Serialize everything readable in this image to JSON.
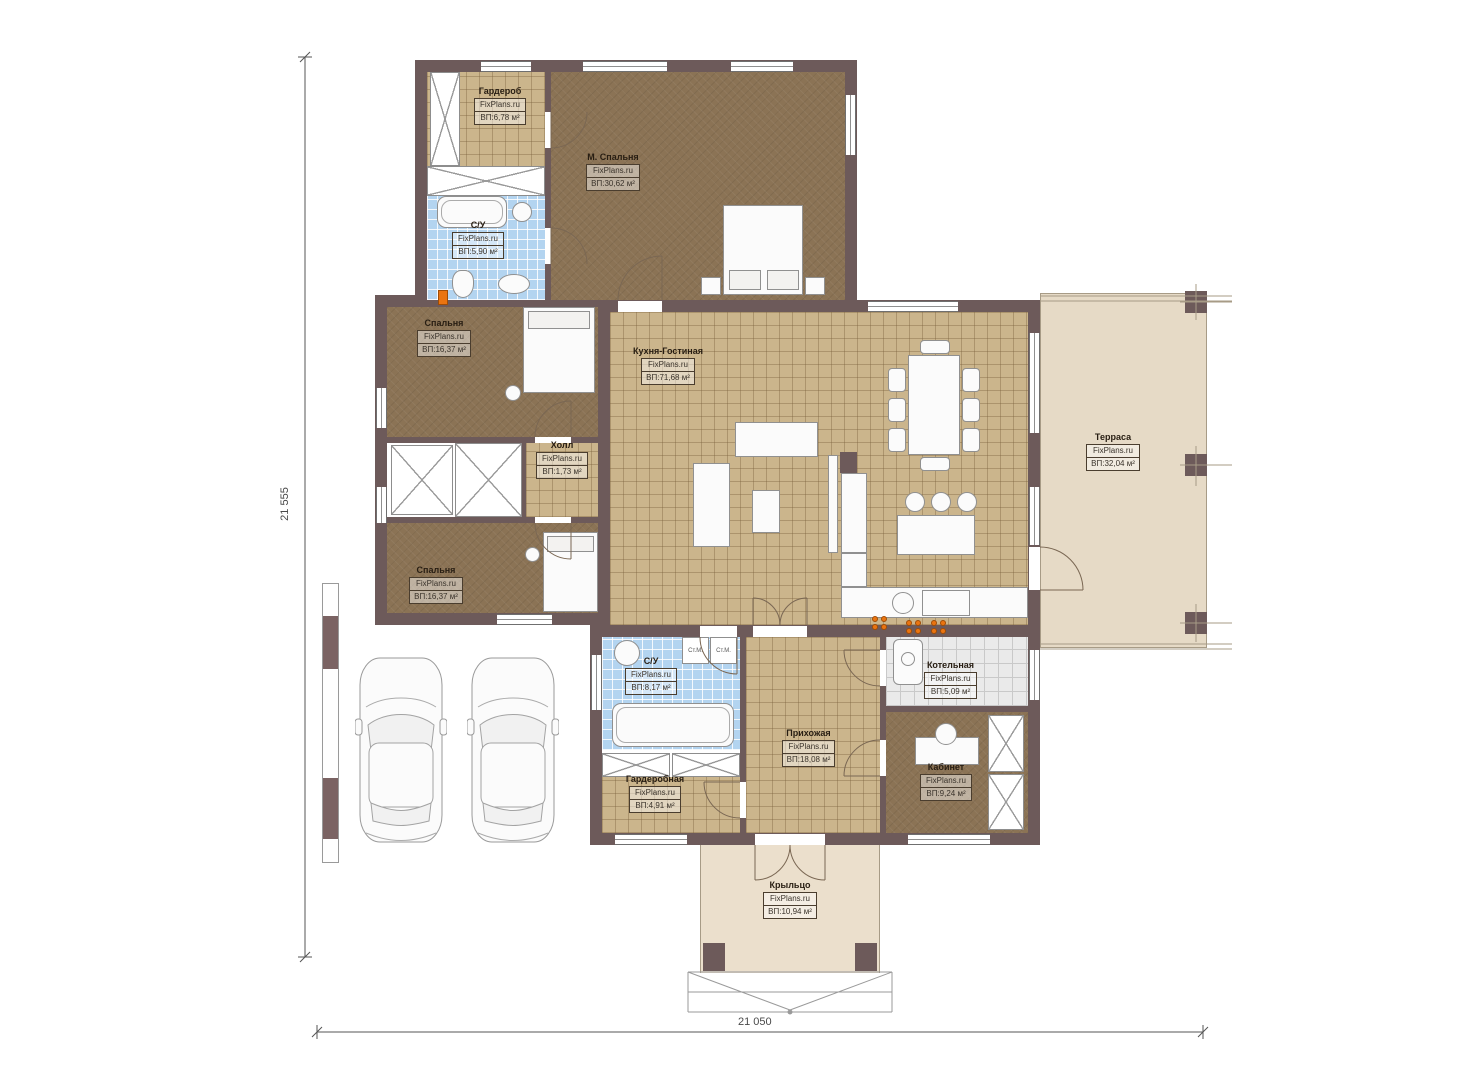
{
  "watermark": "FixPlans.ru",
  "rooms": {
    "garderob": {
      "name": "Гардероб",
      "area": "ВП:6,78 м²"
    },
    "su_top": {
      "name": "С/У",
      "area": "ВП:5,90 м²"
    },
    "master": {
      "name": "М. Спальня",
      "area": "ВП:30,62 м²"
    },
    "bedroom1": {
      "name": "Спальня",
      "area": "ВП:16,37 м²"
    },
    "hall": {
      "name": "Холл",
      "area": "ВП:1,73 м²"
    },
    "bedroom2": {
      "name": "Спальня",
      "area": "ВП:16,37 м²"
    },
    "kitchen_living": {
      "name": "Кухня-Гостиная",
      "area": "ВП:71,68 м²"
    },
    "terrace": {
      "name": "Терраса",
      "area": "ВП:32,04 м²"
    },
    "su_bottom": {
      "name": "С/У",
      "area": "ВП:8,17 м²"
    },
    "hallway": {
      "name": "Прихожая",
      "area": "ВП:18,08 м²"
    },
    "boiler": {
      "name": "Котельная",
      "area": "ВП:5,09 м²"
    },
    "cabinet": {
      "name": "Кабинет",
      "area": "ВП:9,24 м²"
    },
    "wardrobe2": {
      "name": "Гардеробная",
      "area": "ВП:4,91 м²"
    },
    "porch": {
      "name": "Крыльцо",
      "area": "ВП:10,94 м²"
    }
  },
  "appliances": {
    "washer1_label": "Ст.М.",
    "washer2_label": "Ст.М."
  },
  "dimensions": {
    "height_label": "21 555",
    "width_label": "21 050"
  },
  "colors": {
    "wall": "#6d5a5a",
    "floor_brown": "#8b7355",
    "floor_tan": "#cbb58c",
    "floor_blue": "#b3d4f0",
    "terrace": "#e6dac6",
    "accent_orange": "#ea7410"
  }
}
